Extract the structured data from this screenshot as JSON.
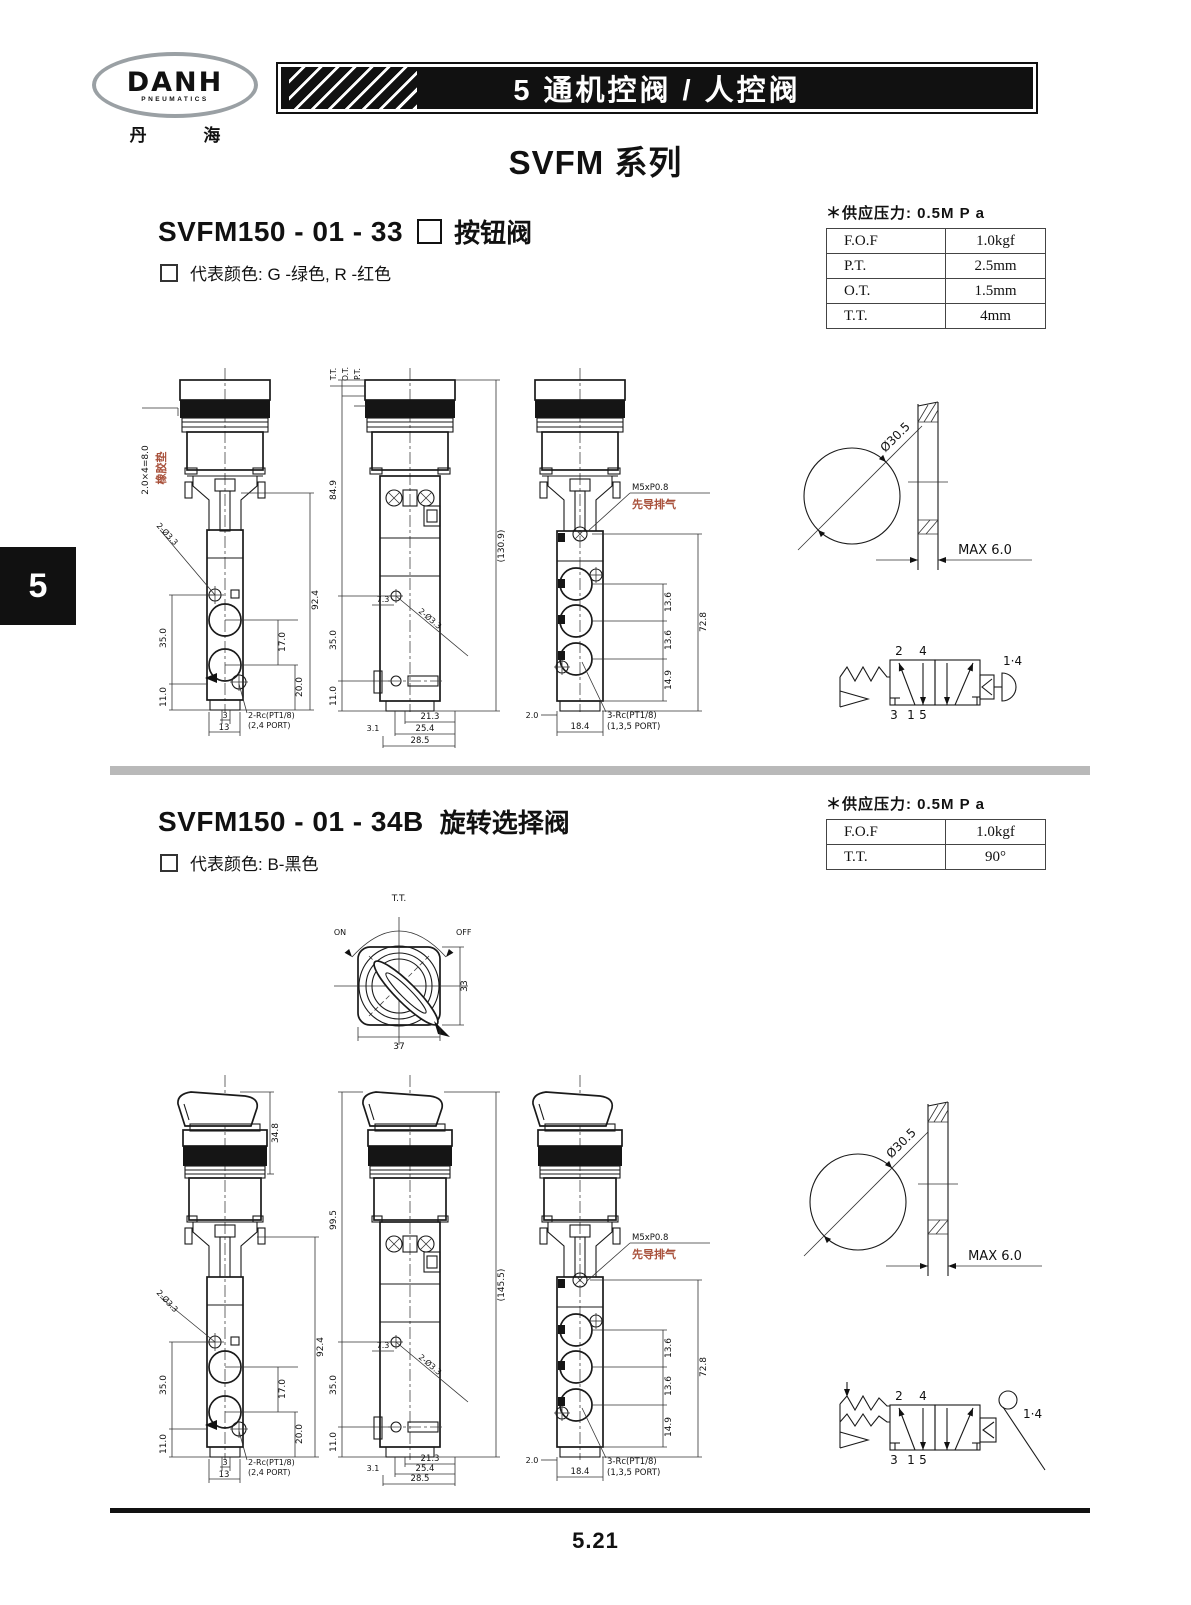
{
  "tab": "5",
  "header": {
    "brand": "DANH",
    "brand_sub": "PNEUMATICS",
    "brand_cn": "丹  海",
    "banner": "5 通机控阀 / 人控阀",
    "series": "SVFM 系列"
  },
  "s1": {
    "model": "SVFM150 - 01 - 33",
    "type_name": "按钮阀",
    "color_note": "代表颜色: G -绿色, R -红色",
    "supply": "＊供应压力: 0.5M P a",
    "spec": [
      {
        "k": "F.O.F",
        "v": "1.0kgf"
      },
      {
        "k": "P.T.",
        "v": "2.5mm"
      },
      {
        "k": "O.T.",
        "v": "1.5mm"
      },
      {
        "k": "T.T.",
        "v": "4mm"
      }
    ],
    "d1": {
      "rubdim": "2.0×4=8.0",
      "rublab": "橡胶垫",
      "hole": "2-Ø3.3",
      "h92": "92.4",
      "h35": "35.0",
      "h17": "17.0",
      "h20": "20.0",
      "h11": "11.0",
      "w3": "3",
      "w13": "13",
      "port": "2-Rc(PT1/8)",
      "portp": "(2,4 PORT)"
    },
    "d2": {
      "tt": "T.T.",
      "ot": "O.T.",
      "pt": "P.T.",
      "h84": "84.9",
      "h130": "(130.9)",
      "h35": "35.0",
      "h11": "11.0",
      "w73": "7.3",
      "hole": "2-Ø3.3",
      "b31": "3.1",
      "b213": "21.3",
      "b254": "25.4",
      "b285": "28.5"
    },
    "d3": {
      "thread": "M5xP0.8",
      "pilot": "先导排气",
      "h72": "72.8",
      "h13a": "13.6",
      "h13b": "13.6",
      "h14": "14.9",
      "w2": "2.0",
      "w18": "18.4",
      "port": "3-Rc(PT1/8)",
      "portp": "(1,3,5 PORT)"
    },
    "cut": {
      "dia": "Ø30.5",
      "max": "MAX 6.0"
    },
    "sym": {
      "a2": "2",
      "a4": "4",
      "a3": "3",
      "a1": "1",
      "a5": "5",
      "a14": "1·4"
    }
  },
  "s2": {
    "model": "SVFM150 - 01 - 34B",
    "type_name": "旋转选择阀",
    "color_note": "代表颜色: B-黑色",
    "supply": "＊供应压力: 0.5M P a",
    "spec": [
      {
        "k": "F.O.F",
        "v": "1.0kgf"
      },
      {
        "k": "T.T.",
        "v": "90°"
      }
    ],
    "top": {
      "tt": "T.T.",
      "on": "ON",
      "off": "OFF",
      "d33": "33",
      "d37": "37"
    },
    "d1": {
      "h34": "34.8",
      "hole": "2-Ø3.3",
      "h92": "92.4",
      "h35": "35.0",
      "h17": "17.0",
      "h20": "20.0",
      "h11": "11.0",
      "w3": "3",
      "w13": "13",
      "port": "2-Rc(PT1/8)",
      "portp": "(2,4 PORT)"
    },
    "d2": {
      "h99": "99.5",
      "h145": "(145.5)",
      "h35": "35.0",
      "h11": "11.0",
      "w73": "7.3",
      "hole": "2-Ø3.3",
      "b31": "3.1",
      "b213": "21.3",
      "b254": "25.4",
      "b285": "28.5"
    },
    "d3": {
      "thread": "M5xP0.8",
      "pilot": "先导排气",
      "h72": "72.8",
      "h13a": "13.6",
      "h13b": "13.6",
      "h14": "14.9",
      "w2": "2.0",
      "w18": "18.4",
      "port": "3-Rc(PT1/8)",
      "portp": "(1,3,5 PORT)"
    },
    "cut": {
      "dia": "Ø30.5",
      "max": "MAX 6.0"
    },
    "sym": {
      "a2": "2",
      "a4": "4",
      "a3": "3",
      "a1": "1",
      "a5": "5",
      "a14": "1·4"
    }
  },
  "footer": {
    "page": "5.21"
  },
  "colors": {
    "accent_red": "#a8503a",
    "divider_gray": "#b9b9b9"
  }
}
